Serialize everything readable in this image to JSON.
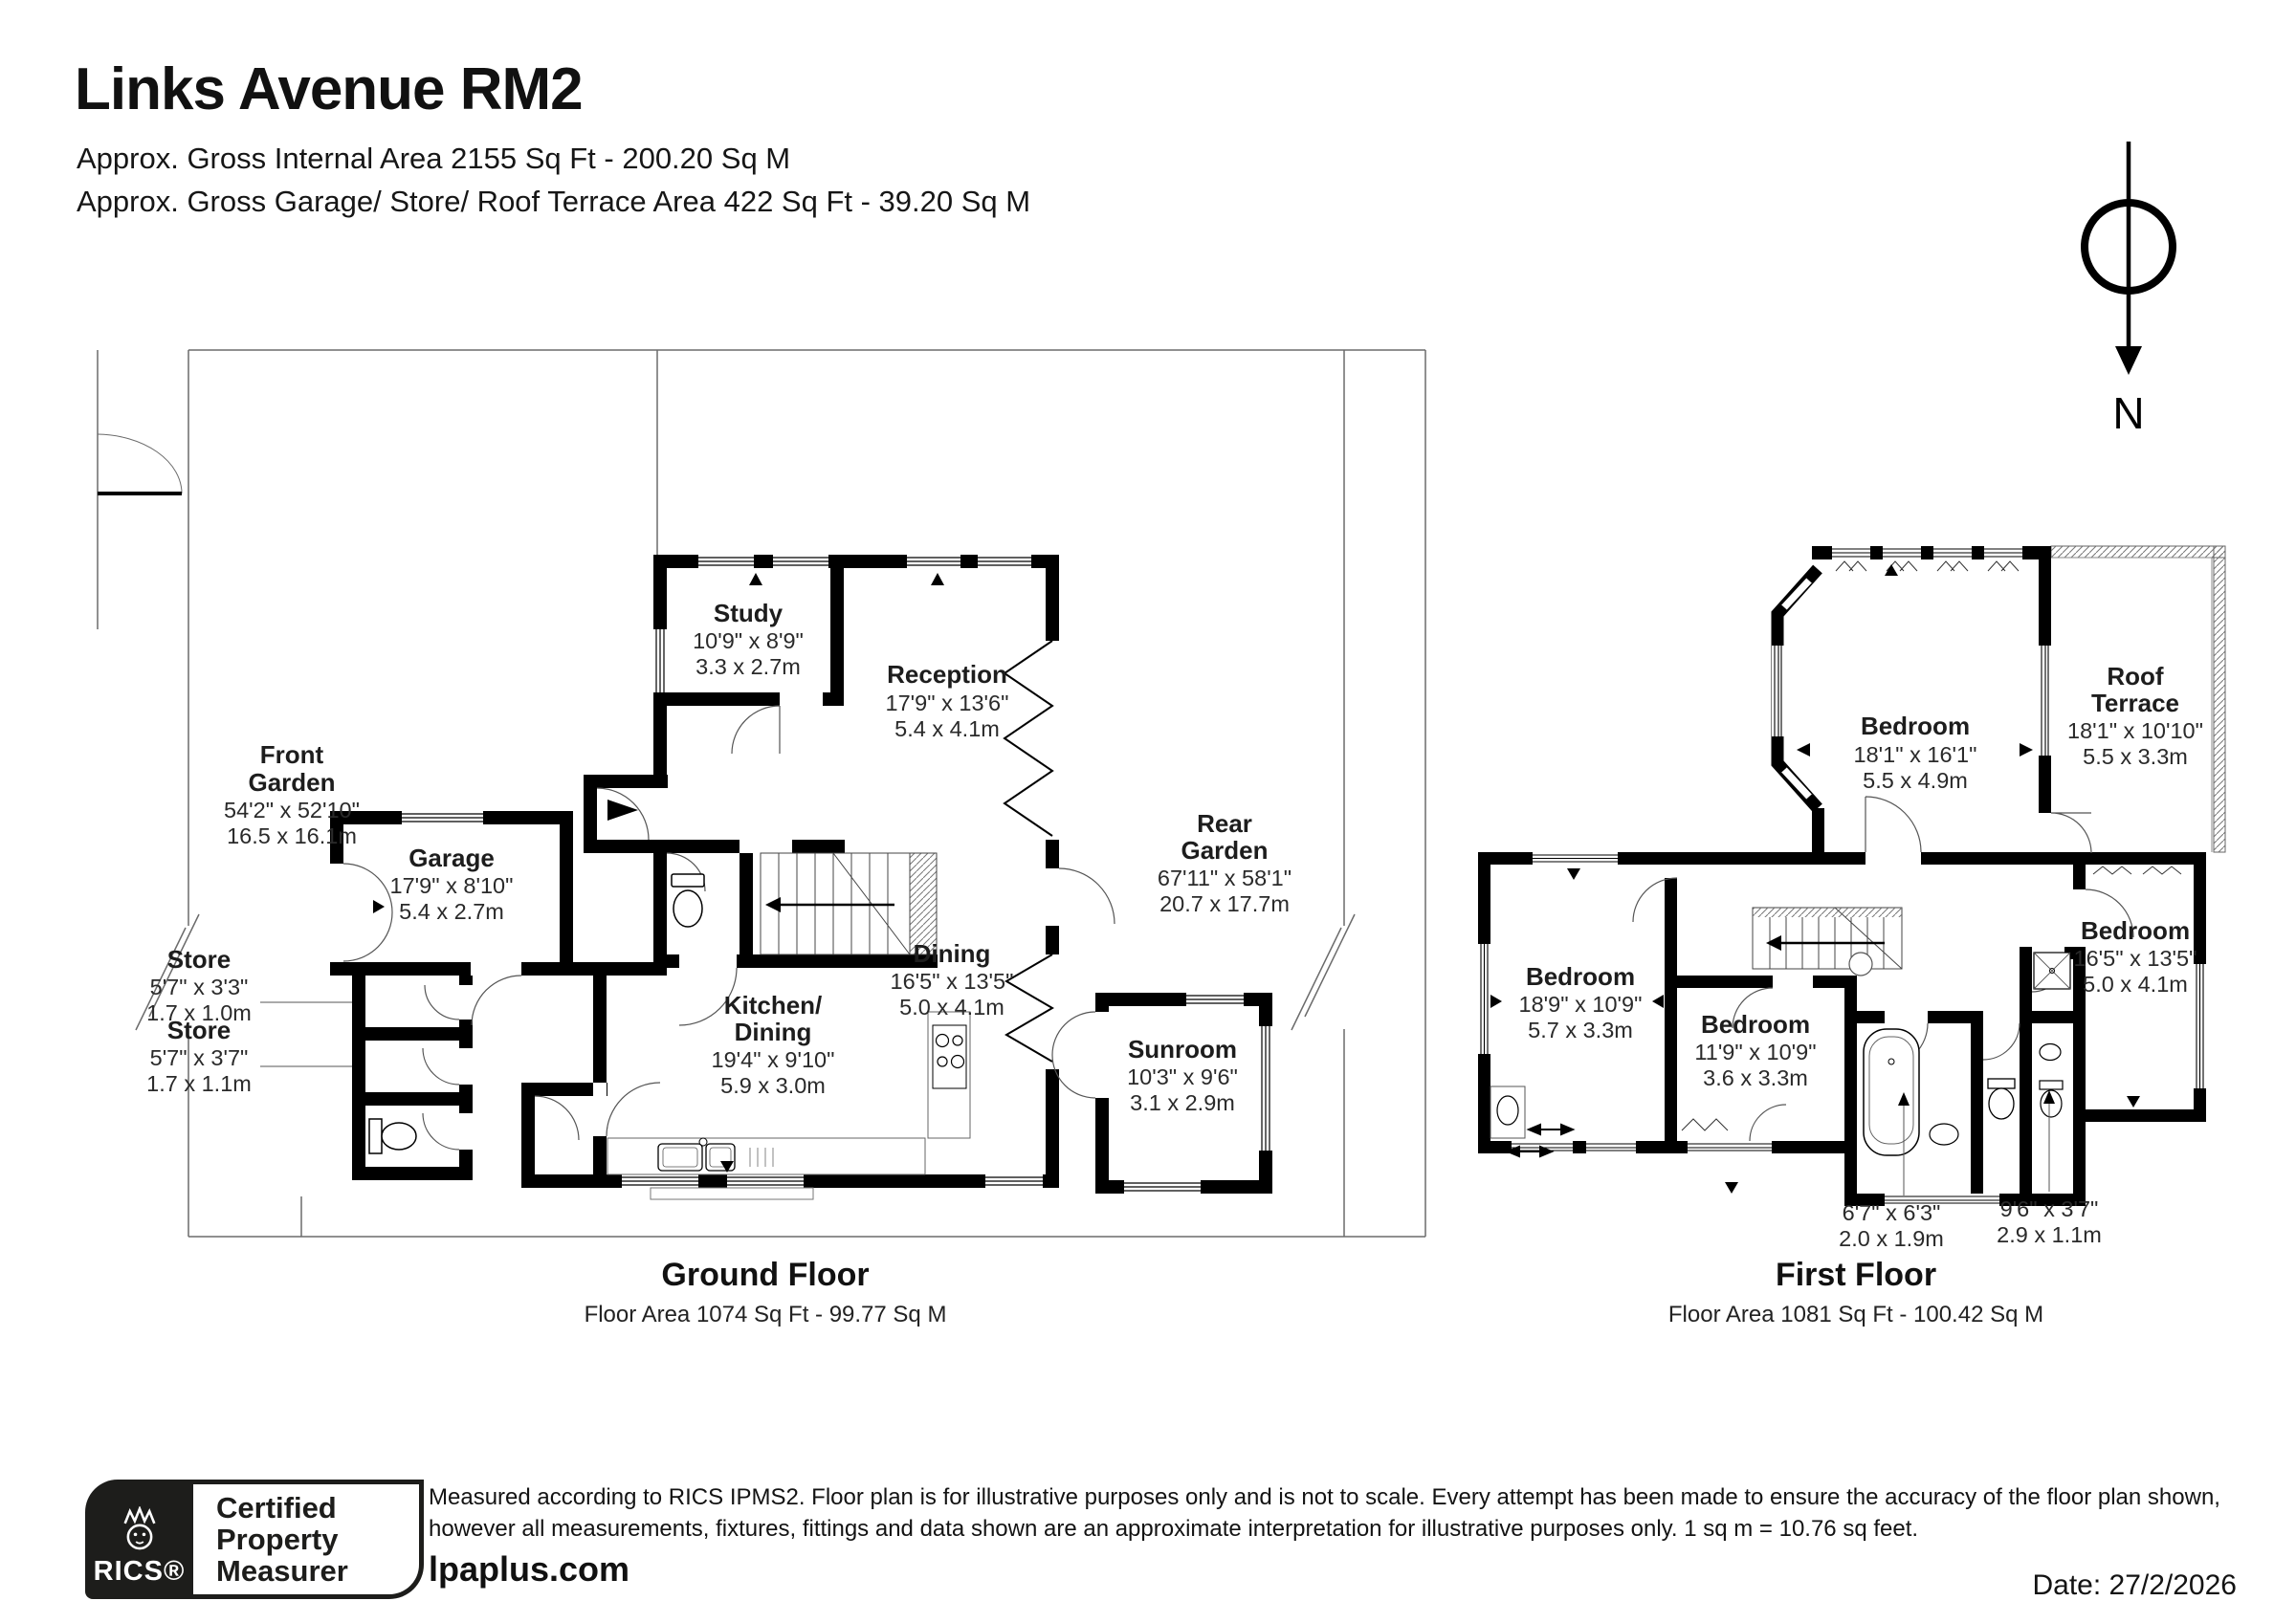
{
  "header": {
    "title": "Links Avenue RM2",
    "subtitle1": "Approx. Gross Internal Area 2155 Sq Ft - 200.20 Sq M",
    "subtitle2": "Approx. Gross Garage/ Store/ Roof Terrace Area 422 Sq Ft - 39.20 Sq M"
  },
  "compass": {
    "north_label": "N"
  },
  "ground_floor": {
    "caption": "Ground Floor",
    "area_line": "Floor Area 1074 Sq Ft - 99.77 Sq M",
    "rooms": {
      "front_garden": {
        "line1": "Front",
        "line2": "Garden",
        "imperial": "54'2\" x 52'10\"",
        "metric": "16.5 x 16.1m"
      },
      "rear_garden": {
        "line1": "Rear",
        "line2": "Garden",
        "imperial": "67'11\" x 58'1\"",
        "metric": "20.7 x 17.7m"
      },
      "study": {
        "name": "Study",
        "imperial": "10'9\" x 8'9\"",
        "metric": "3.3 x 2.7m"
      },
      "reception": {
        "name": "Reception",
        "imperial": "17'9\" x 13'6\"",
        "metric": "5.4 x 4.1m"
      },
      "garage": {
        "name": "Garage",
        "imperial": "17'9\" x 8'10\"",
        "metric": "5.4 x 2.7m"
      },
      "store1": {
        "name": "Store",
        "imperial": "5'7\" x 3'3\"",
        "metric": "1.7 x 1.0m"
      },
      "store2": {
        "name": "Store",
        "imperial": "5'7\" x 3'7\"",
        "metric": "1.7 x 1.1m"
      },
      "kitchen_dining": {
        "line1": "Kitchen/",
        "line2": "Dining",
        "imperial": "19'4\" x 9'10\"",
        "metric": "5.9 x 3.0m"
      },
      "dining": {
        "name": "Dining",
        "imperial": "16'5\" x 13'5\"",
        "metric": "5.0 x 4.1m"
      },
      "sunroom": {
        "name": "Sunroom",
        "imperial": "10'3\" x 9'6\"",
        "metric": "3.1 x 2.9m"
      }
    }
  },
  "first_floor": {
    "caption": "First Floor",
    "area_line": "Floor Area 1081 Sq Ft - 100.42 Sq M",
    "rooms": {
      "bedroom_main": {
        "name": "Bedroom",
        "imperial": "18'1\" x 16'1\"",
        "metric": "5.5 x 4.9m"
      },
      "roof_terrace": {
        "line1": "Roof",
        "line2": "Terrace",
        "imperial": "18'1\" x 10'10\"",
        "metric": "5.5 x 3.3m"
      },
      "bedroom_left": {
        "name": "Bedroom",
        "imperial": "18'9\" x 10'9\"",
        "metric": "5.7 x 3.3m"
      },
      "bedroom_middle": {
        "name": "Bedroom",
        "imperial": "11'9\" x 10'9\"",
        "metric": "3.6 x 3.3m"
      },
      "bedroom_right": {
        "name": "Bedroom",
        "imperial": "16'5\" x 13'5\"",
        "metric": "5.0 x 4.1m"
      },
      "bathroom": {
        "imperial": "6'7\" x 6'3\"",
        "metric": "2.0 x 1.9m"
      },
      "shower_room": {
        "imperial": "9'6\" x 3'7\"",
        "metric": "2.9 x 1.1m"
      }
    }
  },
  "footer": {
    "badge": {
      "brand": "RICS®",
      "line1": "Certified",
      "line2": "Property",
      "line3": "Measurer"
    },
    "website": "lpaplus.com",
    "disclaimer_line1": "Measured according to RICS IPMS2. Floor plan is for illustrative purposes only and is not to scale. Every attempt has been made to ensure the accuracy of the floor plan shown,",
    "disclaimer_line2": "however all measurements, fixtures, fittings and data shown are an approximate interpretation for illustrative purposes only. 1 sq m = 10.76 sq feet.",
    "date": "Date: 27/2/2026"
  }
}
